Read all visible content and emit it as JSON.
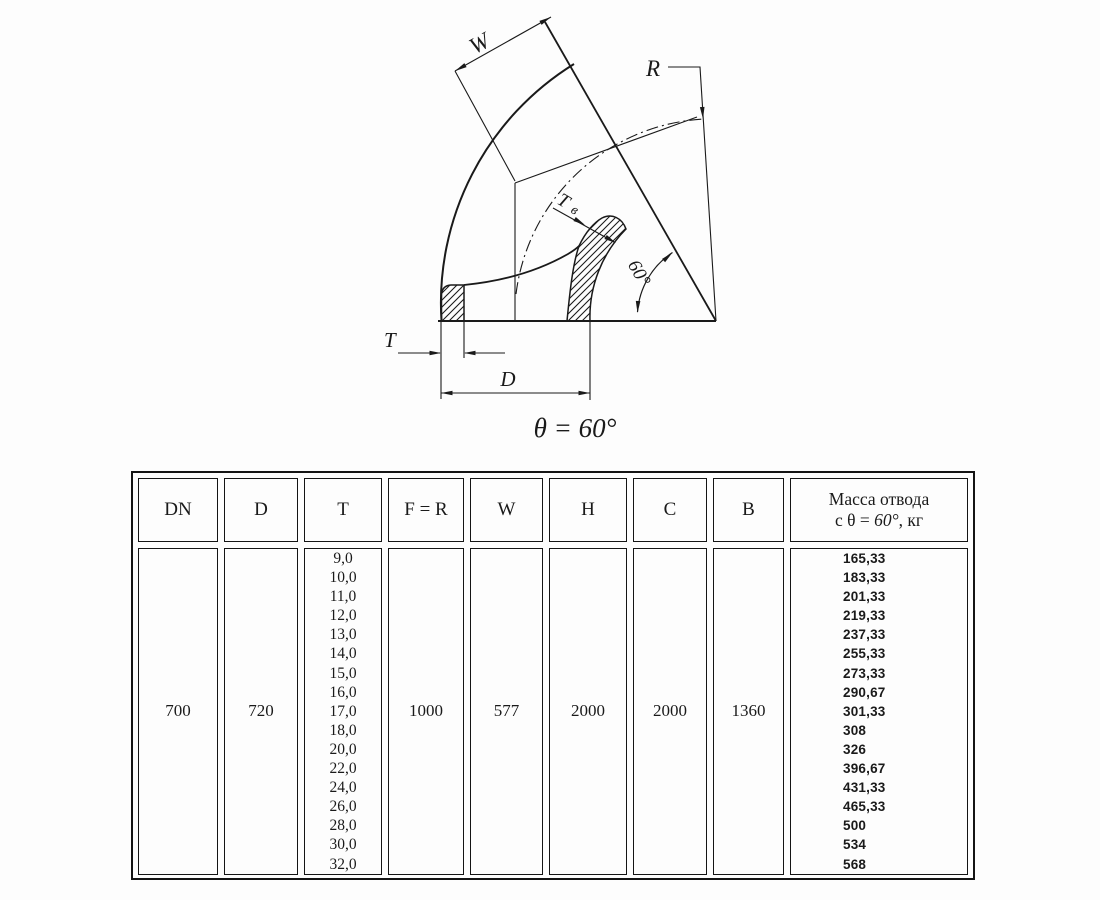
{
  "diagram": {
    "labels": {
      "w": "W",
      "r": "R",
      "tv_main": "Т",
      "tv_sub": "в",
      "t": "T",
      "d": "D",
      "angle": "60°"
    },
    "caption": "θ = 60°"
  },
  "table": {
    "headers": {
      "dn": "DN",
      "d": "D",
      "t": "T",
      "fr": "F = R",
      "w": "W",
      "h": "H",
      "c": "C",
      "b": "B",
      "mass_line1": "Масса отвода",
      "mass_prefix": "с θ = ",
      "mass_angle": "60°",
      "mass_suffix": ", кг"
    },
    "values": {
      "dn": "700",
      "d": "720",
      "fr": "1000",
      "w": "577",
      "h": "2000",
      "c": "2000",
      "b": "1360"
    },
    "t_values": [
      "9,0",
      "10,0",
      "11,0",
      "12,0",
      "13,0",
      "14,0",
      "15,0",
      "16,0",
      "17,0",
      "18,0",
      "20,0",
      "22,0",
      "24,0",
      "26,0",
      "28,0",
      "30,0",
      "32,0"
    ],
    "mass_values": [
      "165,33",
      "183,33",
      "201,33",
      "219,33",
      "237,33",
      "255,33",
      "273,33",
      "290,67",
      "301,33",
      "308",
      "326",
      "396,67",
      "431,33",
      "465,33",
      "500",
      "534",
      "568"
    ]
  }
}
